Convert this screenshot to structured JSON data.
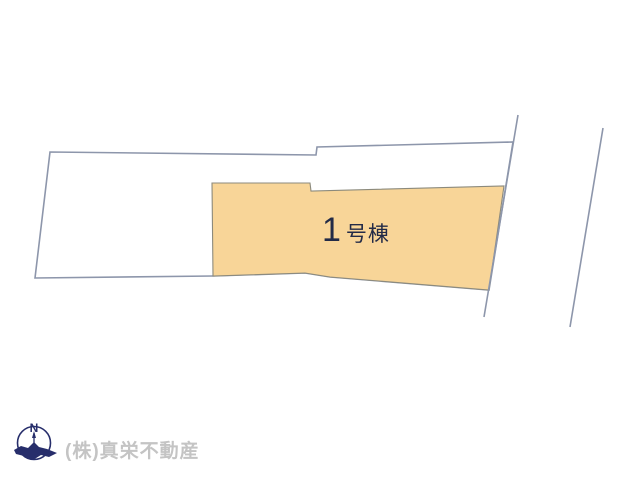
{
  "page": {
    "background": "#ffffff"
  },
  "plan": {
    "outline_color": "#8d96ab",
    "outline_width": 1.6,
    "parcel": {
      "name": "site-parcel",
      "points": "50,152 316,155 317,147 513,142 489,290 330,277 305,273 213,276 35,278",
      "fill": "#ffffff"
    },
    "building": {
      "label": "1号棟",
      "label_number": "1",
      "label_suffix": "号棟",
      "label_color": "#232b47",
      "points": "212,183 310,183 311,191 504,186 489,290 330,277 305,273 213,276",
      "fill": "#f8d598",
      "stroke": "#8c8a7c",
      "stroke_width": 1.1
    },
    "right_boundary_line": {
      "x1": 518,
      "y1": 115,
      "x2": 484,
      "y2": 317
    },
    "detached_boundary_line": {
      "x1": 603,
      "y1": 128,
      "x2": 570,
      "y2": 327
    }
  },
  "footer": {
    "company": "(株)真栄不動産",
    "company_color": "#c4c4c4",
    "compass": {
      "label": "N",
      "color": "#272e6b",
      "needle": "21,12 19,19 23,19",
      "bird": "1,31 8,27 15,29 21,23 26,28 34,30 44,34 36,38 28,36 20,41 11,37 3,35"
    }
  }
}
